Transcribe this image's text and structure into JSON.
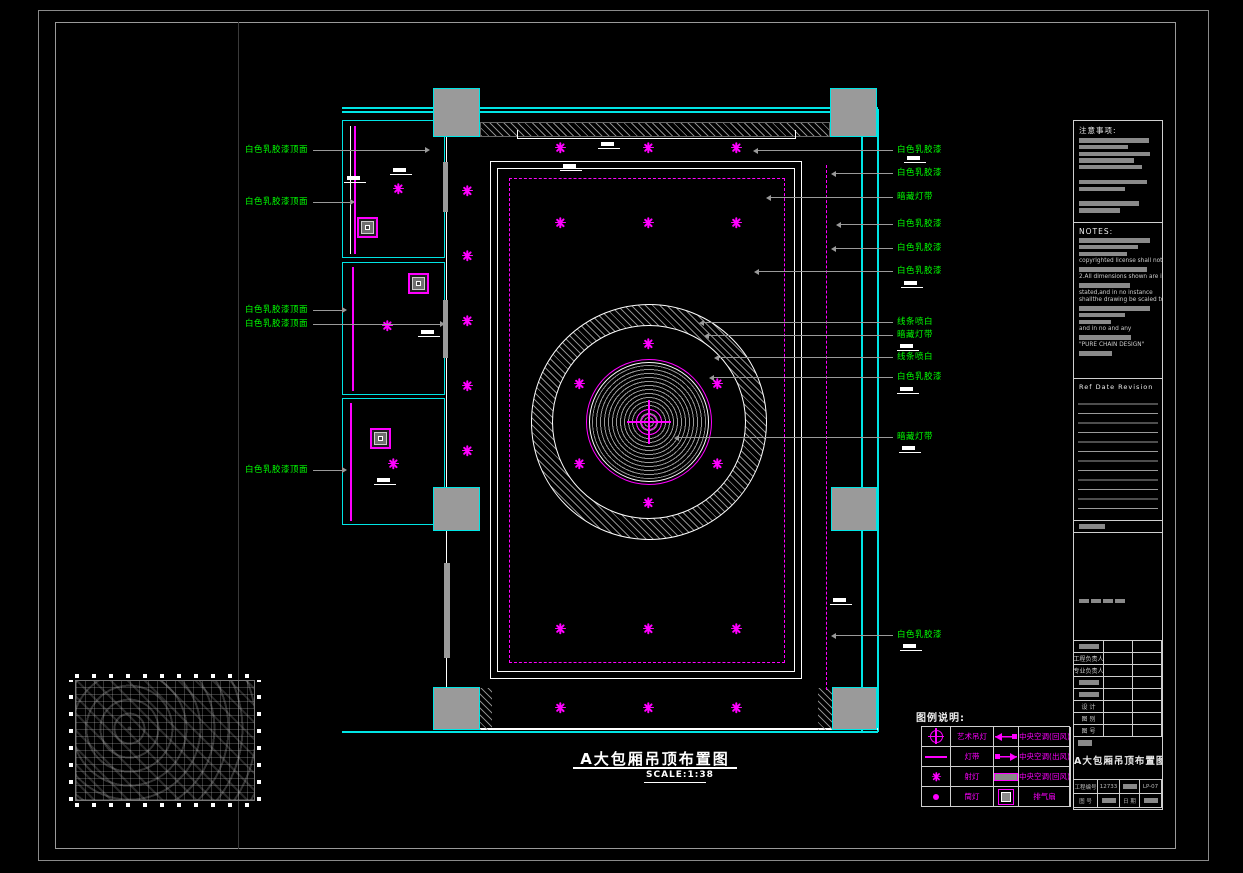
{
  "colors": {
    "wall_cyan": "#00e5e5",
    "light_magenta": "#ff00ff",
    "callout_green": "#00ff00",
    "column_gray": "#9a9a9a",
    "paper_black": "#000000"
  },
  "sheet": {
    "name": "A大包厢吊顶布置图",
    "scale": "SCALE:1:38"
  },
  "legend": {
    "header": "图例说明:",
    "rows": [
      {
        "left_symbol": "art-chandelier-icon",
        "left_label": "艺术吊灯",
        "right_symbol": "ac-return-icon",
        "right_label": "中央空调(回风)"
      },
      {
        "left_symbol": "light-strip-icon",
        "left_label": "灯带",
        "right_symbol": "ac-supply-icon",
        "right_label": "中央空调(出风)"
      },
      {
        "left_symbol": "spotlight-icon",
        "left_label": "射灯",
        "right_symbol": "ac-grille-icon",
        "right_label": "中央空调(回风)"
      },
      {
        "left_symbol": "downlight-icon",
        "left_label": "筒灯",
        "right_symbol": "exhaust-fan-icon",
        "right_label": "排气扇"
      }
    ]
  },
  "title_block": {
    "title": "A大包厢吊顶布置图",
    "bottom_rows": [
      [
        {
          "t": "工程编号"
        },
        {
          "t": "12733"
        },
        {
          "t": "",
          "bar": true
        },
        {
          "t": "LP-07"
        }
      ],
      [
        {
          "t": "图 号"
        },
        {
          "t": "",
          "bar": true
        },
        {
          "t": "日 期"
        },
        {
          "t": "",
          "bar": true
        }
      ]
    ]
  },
  "right_panel": {
    "caution_header": "注意事项:",
    "caution_items": [
      {
        "type": "bar",
        "w": 88
      },
      {
        "type": "bar",
        "w": 62
      },
      {
        "type": "bar",
        "w": 90
      },
      {
        "type": "bar",
        "w": 70
      },
      {
        "type": "bar",
        "w": 80
      },
      {
        "type": "gap"
      },
      {
        "type": "bar",
        "w": 86
      },
      {
        "type": "bar",
        "w": 58
      },
      {
        "type": "gap"
      },
      {
        "type": "bar",
        "w": 76
      },
      {
        "type": "bar",
        "w": 52
      }
    ],
    "notes_header": "NOTES:",
    "notes_items": [
      {
        "type": "bar",
        "w": 90
      },
      {
        "type": "bar",
        "w": 74
      },
      {
        "type": "bar",
        "w": 60
      },
      {
        "type": "text",
        "t": "copyrighted license shall not"
      },
      {
        "type": "bar",
        "w": 86
      },
      {
        "type": "text",
        "t": "2.All dimensions shown are in"
      },
      {
        "type": "bar",
        "w": 64
      },
      {
        "type": "text",
        "t": "stated,and in no instance"
      },
      {
        "type": "text",
        "t": "shallthe drawing be scaled to"
      },
      {
        "type": "bar",
        "w": 90
      },
      {
        "type": "bar",
        "w": 58
      },
      {
        "type": "bar",
        "w": 40
      },
      {
        "type": "text",
        "t": "and in no and any"
      },
      {
        "type": "bar",
        "w": 66
      },
      {
        "type": "text",
        "t": "\"PURE CHAIN DESIGN\""
      },
      {
        "type": "bar",
        "w": 42
      }
    ],
    "revision_header": "Ref   Date   Revision",
    "table_rows": [
      {
        "label": "",
        "bar": true
      },
      {
        "label": "工程负责人"
      },
      {
        "label": "专业负责人"
      },
      {
        "label": "",
        "bar": true
      },
      {
        "label": "",
        "bar": true
      },
      {
        "label": "设 计"
      },
      {
        "label": "图 别"
      },
      {
        "label": "图 号"
      }
    ]
  },
  "drawing": {
    "spotlights": [
      [
        398,
        188
      ],
      [
        387,
        325
      ],
      [
        393,
        463
      ],
      [
        467,
        190
      ],
      [
        467,
        255
      ],
      [
        467,
        320
      ],
      [
        467,
        385
      ],
      [
        467,
        450
      ],
      [
        560,
        147
      ],
      [
        648,
        147
      ],
      [
        736,
        147
      ],
      [
        560,
        222
      ],
      [
        648,
        222
      ],
      [
        736,
        222
      ],
      [
        648,
        343
      ],
      [
        579,
        383
      ],
      [
        717,
        383
      ],
      [
        579,
        463
      ],
      [
        717,
        463
      ],
      [
        648,
        502
      ],
      [
        560,
        628
      ],
      [
        648,
        628
      ],
      [
        736,
        628
      ],
      [
        560,
        707
      ],
      [
        648,
        707
      ],
      [
        736,
        707
      ]
    ],
    "exhaust_fans": [
      [
        367,
        227
      ],
      [
        418,
        283
      ],
      [
        380,
        438
      ]
    ],
    "elevation_marks": [
      [
        390,
        168
      ],
      [
        344,
        176
      ],
      [
        598,
        142
      ],
      [
        560,
        164
      ],
      [
        418,
        330
      ],
      [
        374,
        478
      ],
      [
        830,
        598
      ],
      [
        904,
        156
      ],
      [
        901,
        281
      ],
      [
        897,
        344
      ],
      [
        897,
        387
      ],
      [
        899,
        446
      ],
      [
        900,
        644
      ]
    ],
    "callouts_right": [
      {
        "y": 150,
        "x_from": 757,
        "text": "白色乳胶漆"
      },
      {
        "y": 173,
        "x_from": 835,
        "text": "白色乳胶漆"
      },
      {
        "y": 197,
        "x_from": 770,
        "text": "暗藏灯带"
      },
      {
        "y": 224,
        "x_from": 840,
        "text": "白色乳胶漆"
      },
      {
        "y": 248,
        "x_from": 835,
        "text": "白色乳胶漆"
      },
      {
        "y": 271,
        "x_from": 758,
        "text": "白色乳胶漆"
      },
      {
        "y": 322,
        "x_from": 703,
        "text": "线条喷白"
      },
      {
        "y": 335,
        "x_from": 708,
        "text": "暗藏灯带"
      },
      {
        "y": 357,
        "x_from": 718,
        "text": "线条喷白"
      },
      {
        "y": 377,
        "x_from": 713,
        "text": "白色乳胶漆"
      },
      {
        "y": 437,
        "x_from": 678,
        "text": "暗藏灯带"
      },
      {
        "y": 635,
        "x_from": 835,
        "text": "白色乳胶漆"
      }
    ],
    "callouts_left": [
      {
        "y": 150,
        "x_to": 425,
        "text": "白色乳胶漆顶面"
      },
      {
        "y": 202,
        "x_to": 350,
        "text": "白色乳胶漆顶面"
      },
      {
        "y": 310,
        "x_to": 342,
        "text": "白色乳胶漆顶面"
      },
      {
        "y": 324,
        "x_to": 440,
        "text": "白色乳胶漆顶面"
      },
      {
        "y": 470,
        "x_to": 342,
        "text": "白色乳胶漆顶面"
      }
    ]
  }
}
